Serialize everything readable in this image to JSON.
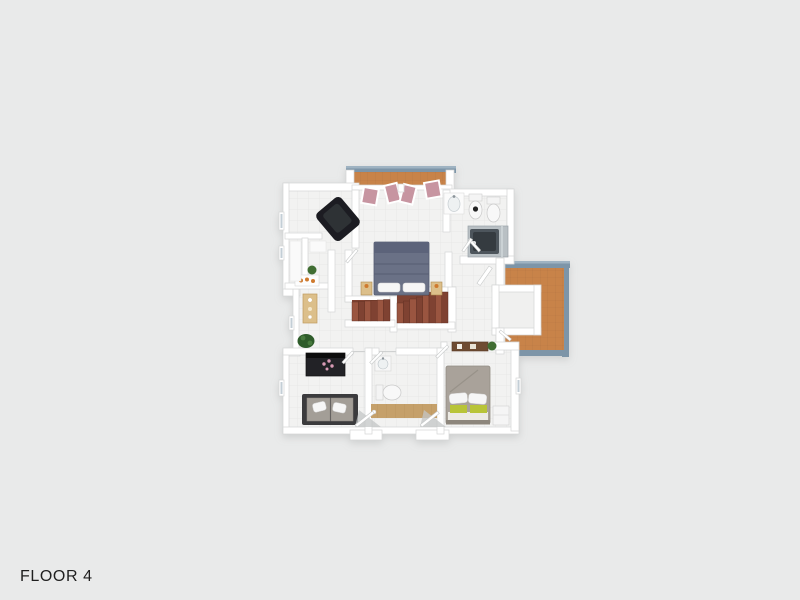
{
  "floor_label": "FLOOR 4",
  "colors": {
    "background": "#e9eaea",
    "label": "#1f1f1f",
    "wall": "#ffffff",
    "wall_edge": "#d4d6d6",
    "floor": "#f2f2f1",
    "floor_grid": "#e5e5e4",
    "terracotta": "#c8834a",
    "terracotta_grid": "#a5673a",
    "railing": "#7d95a8",
    "railing_light": "#9fb3c2",
    "stair": "#9a5540",
    "stair_dark": "#7f4232",
    "master_bed": "#6a7186",
    "master_bed_dark": "#5c637a",
    "pillow": "#f6f6f6",
    "armchair": "#1d1f22",
    "armchair_cushion": "#2e3136",
    "sofa_frame": "#3a3a3e",
    "sofa_cushion": "#a39e97",
    "dresser": "#242427",
    "flower_pink": "#d89ab5",
    "guest_bed": "#a9a29a",
    "blanket_green": "#b8c437",
    "wood_light": "#dcbf8a",
    "wood_floor": "#c5a06b",
    "desk_brown": "#6e4b33",
    "plant_green": "#3f6d33",
    "plant_dark": "#2f5c2b",
    "fixture_gray": "#b9c0c4",
    "tub_dark": "#4e555b",
    "door_pink": "#c795a1",
    "shadow": "#c3c6c6",
    "accent_orange": "#cf7a2e"
  }
}
